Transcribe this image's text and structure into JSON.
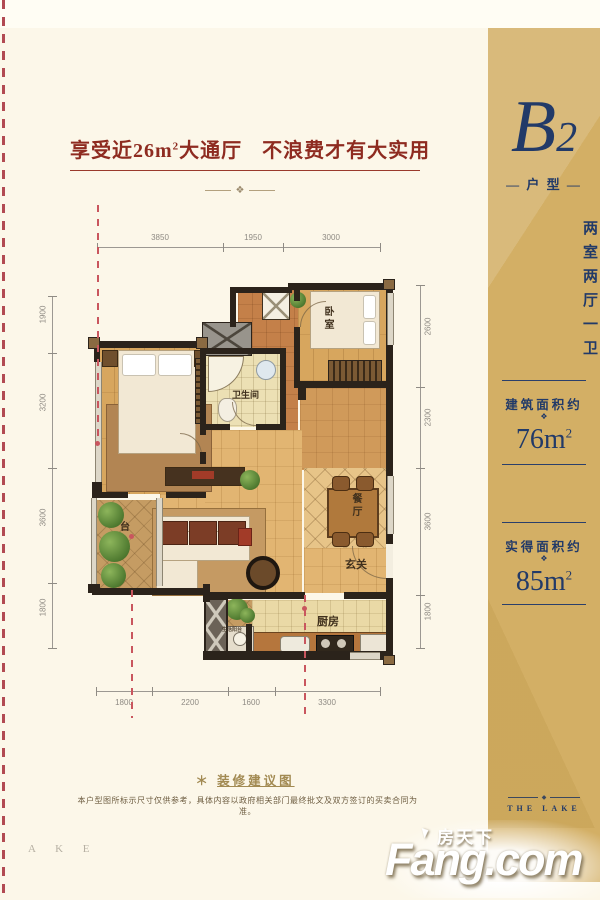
{
  "header": {
    "title_p1": "享受近26m",
    "title_sup": "2",
    "title_p2": "大通厅",
    "title_p3": "不浪费才有大实用"
  },
  "sidebar": {
    "unit_letter": "B",
    "unit_digit": "2",
    "unit_tag": "— 户 型 —",
    "layout_vertical": "两室两厅一卫",
    "built_area": {
      "label": "建筑面积约",
      "value": "76m",
      "sup": "2"
    },
    "actual_area": {
      "label": "实得面积约",
      "value": "85m",
      "sup": "2"
    },
    "ornament_glyph": "❖",
    "divider_glyph": "◆",
    "brand_en": "THE LAKE"
  },
  "plan": {
    "dims_top": [
      "3850",
      "1950",
      "3000"
    ],
    "dims_left": [
      "1900",
      "3200",
      "3600",
      "1800"
    ],
    "dims_right": [
      "2600",
      "2300",
      "3600",
      "1800"
    ],
    "dims_bottom": [
      "1800",
      "2200",
      "1600",
      "3300"
    ],
    "labels": {
      "bedroom": "卧室",
      "bathroom": "卫生间",
      "balcony": "台",
      "dining": "餐厅",
      "entry": "玄关",
      "kitchen": "厨房",
      "service": "生活阳台"
    }
  },
  "footer": {
    "note_star": "＊",
    "note_title": "装修建议图",
    "disclaimer": "本户型图所标示尺寸仅供参考，具体内容以政府相关部门最终批文及双方签订的买卖合同为准。",
    "watermark": "A K E"
  },
  "logo": {
    "cn": "房天下",
    "en": "Fang.com"
  },
  "colors": {
    "gold": "#d3af65",
    "navy": "#223a68",
    "title_red": "#8e2b20",
    "dash_red": "#c9565e",
    "wall": "#2b231b"
  }
}
